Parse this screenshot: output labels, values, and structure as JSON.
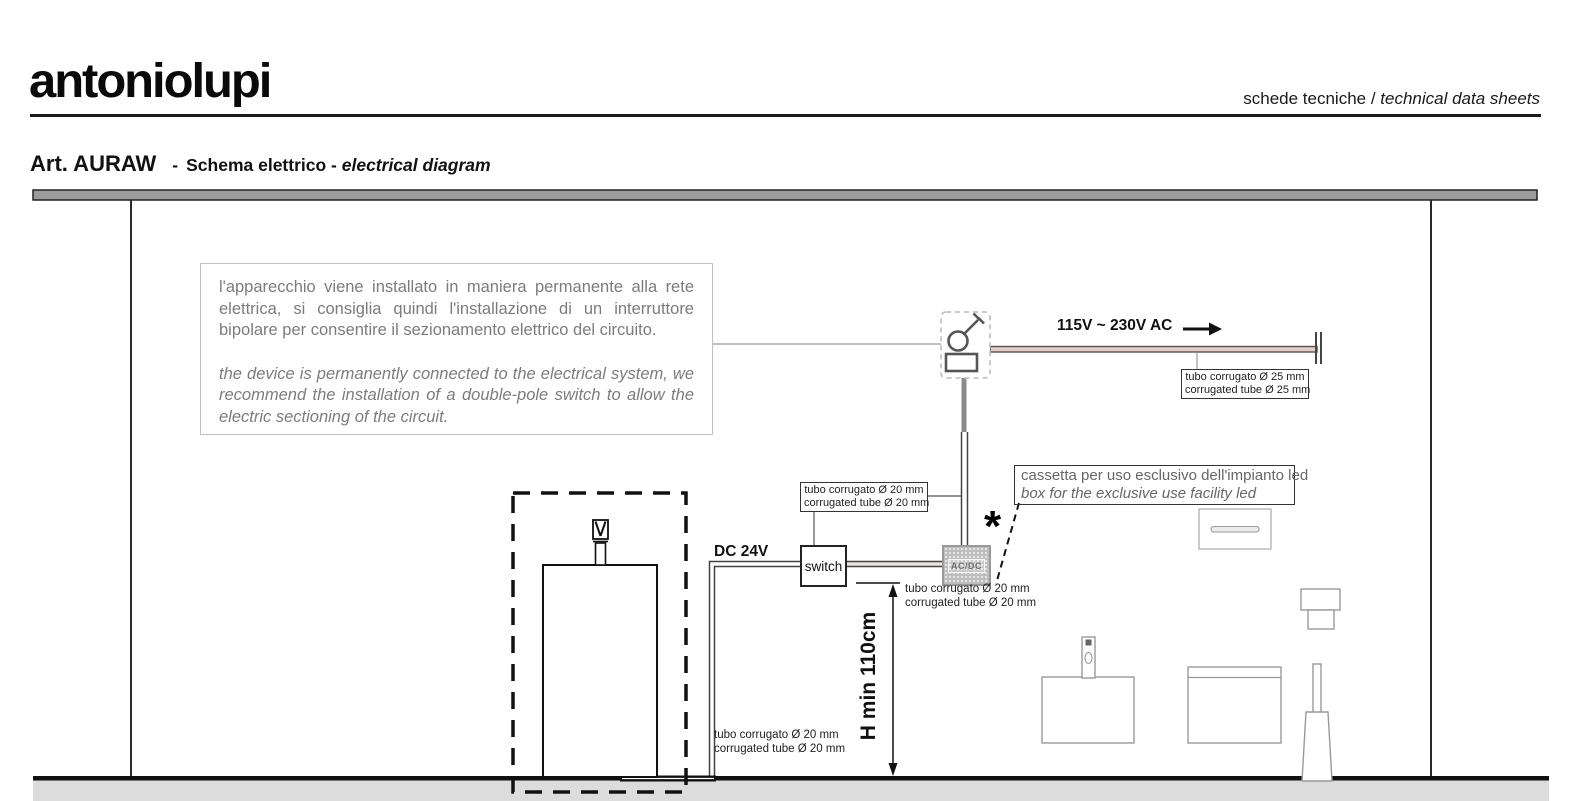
{
  "header": {
    "logo": "antoniolupi",
    "subtitle_it": "schede tecniche / ",
    "subtitle_en": "technical data sheets",
    "title_art": "Art. AURAW",
    "title_sep": "-",
    "title_it": "Schema elettrico - ",
    "title_en": "electrical diagram"
  },
  "note_box": {
    "it": "l'apparecchio viene installato in maniera permanente alla rete elettrica, si consiglia quindi l'installazione di un interruttore bipolare per consentire il sezionamento elettrico del circuito.",
    "en": "the device is permanently connected to the electrical system, we recommend the installation of a double-pole switch to allow the electric sectioning of the circuit."
  },
  "diagram": {
    "ac_voltage_label": "115V ~ 230V AC",
    "dc_voltage_label": "DC 24V",
    "switch_label": "switch",
    "acdc_label": "AC/DC",
    "asterisk": "*",
    "height_dimension_label": "H min 110cm",
    "tube25_label": {
      "line1": "tubo corrugato Ø 25 mm",
      "line2": "corrugated tube Ø 25 mm"
    },
    "tube20_wall_label": {
      "line1": "tubo corrugato Ø 20 mm",
      "line2": "corrugated tube Ø 20 mm"
    },
    "tube20_acdc_label": {
      "line1": "tubo corrugato Ø 20 mm",
      "line2": "corrugated tube Ø 20 mm"
    },
    "tube20_floor_label": {
      "line1": "tubo corrugato Ø 20 mm",
      "line2": "corrugated tube Ø 20 mm"
    },
    "cassetta_label": {
      "line1": "cassetta per uso esclusivo dell'impianto led",
      "line2": "box for the exclusive use facility led"
    },
    "icon_names": [
      "disconnect-switch-icon",
      "ac-dc-converter",
      "faucet-icon",
      "soap-dispenser-icon",
      "accessory-box-icon",
      "toilet-brush-icon",
      "wall-dispenser-icon",
      "led-profile-icon",
      "arrow-right-icon"
    ],
    "colors": {
      "ac_wire_fill": "#e3cdc7",
      "ceiling_gray": "#9b9b9b",
      "floor_gray": "#dcdcdc",
      "note_text_gray": "#7c7c7c",
      "line_black": "#111111",
      "converter_gray": "#bdbdbd"
    }
  }
}
